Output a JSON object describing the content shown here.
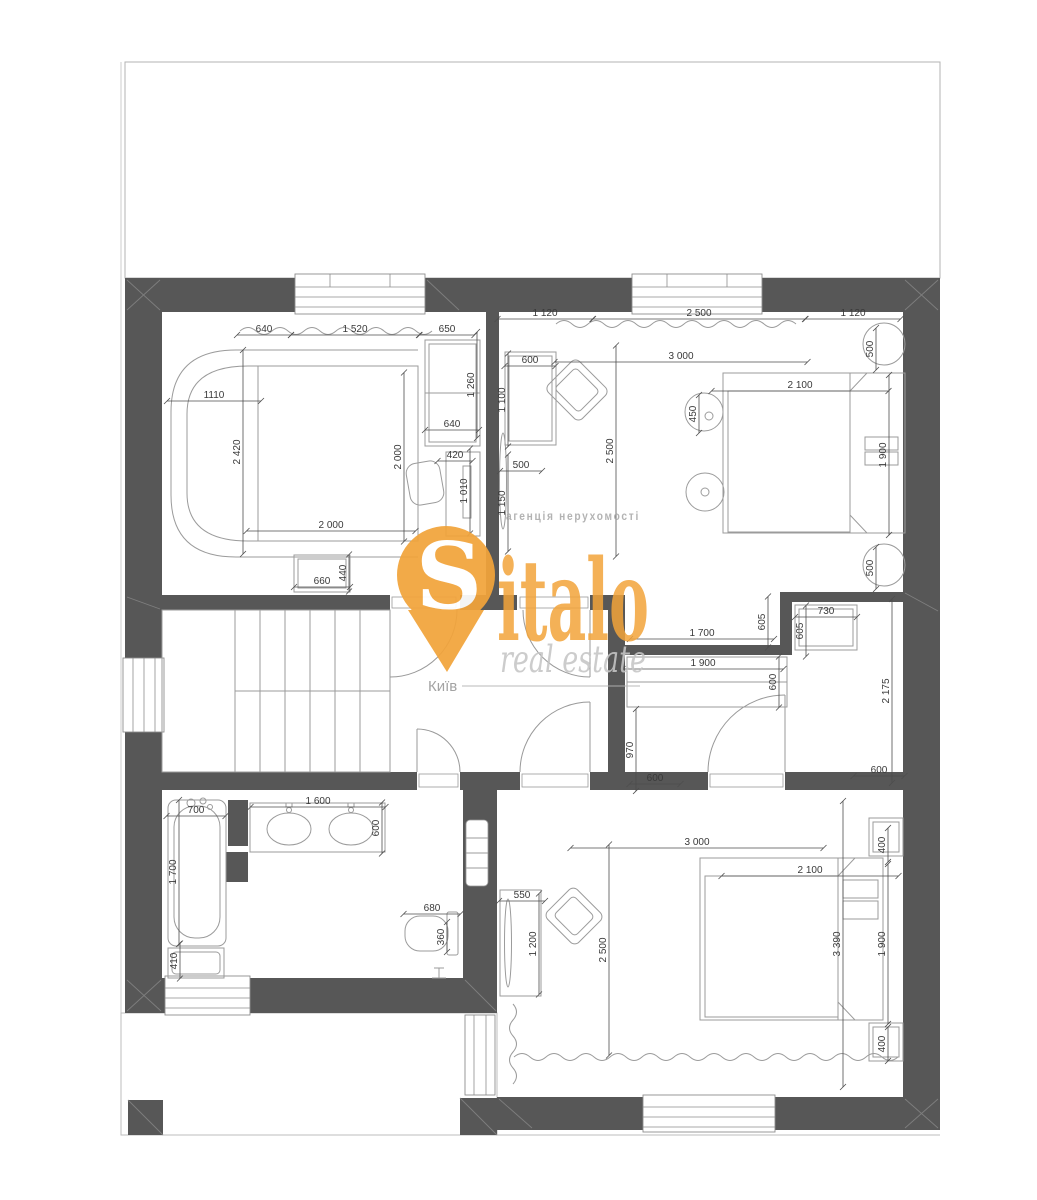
{
  "watermark": {
    "agency": "агенція нерухомості",
    "brand_initial": "S",
    "brand_rest": "italo",
    "tagline": "real estate",
    "city": "Київ"
  },
  "colors": {
    "wall": "#575757",
    "furniture_line": "#9b9b9b",
    "dimension_text": "#3a3a3a",
    "brand_orange": "#F2A43B",
    "tagline_gray": "#c6c6c6"
  },
  "dimensions": [
    {
      "t": "640",
      "x": 264,
      "y": 335,
      "r": 0,
      "l": 54
    },
    {
      "t": "1 520",
      "x": 355,
      "y": 335,
      "r": 0,
      "l": 128
    },
    {
      "t": "650",
      "x": 447,
      "y": 335,
      "r": 0,
      "l": 55
    },
    {
      "t": "1110",
      "x": 214,
      "y": 401,
      "r": 0,
      "l": 94
    },
    {
      "t": "2 420",
      "x": 243,
      "y": 452,
      "r": 1,
      "l": 204
    },
    {
      "t": "1 260",
      "x": 477,
      "y": 385,
      "r": 1,
      "l": 106
    },
    {
      "t": "640",
      "x": 452,
      "y": 430,
      "r": 0,
      "l": 54
    },
    {
      "t": "2 000",
      "x": 404,
      "y": 457,
      "r": 1,
      "l": 169
    },
    {
      "t": "420",
      "x": 455,
      "y": 461,
      "r": 0,
      "l": 35
    },
    {
      "t": "1 010",
      "x": 470,
      "y": 491,
      "r": 1,
      "l": 85
    },
    {
      "t": "2 000",
      "x": 331,
      "y": 531,
      "r": 0,
      "l": 169
    },
    {
      "t": "660",
      "x": 322,
      "y": 587,
      "r": 0,
      "l": 56
    },
    {
      "t": "440",
      "x": 349,
      "y": 573,
      "r": 1,
      "l": 37
    },
    {
      "t": "1 120",
      "x": 545,
      "y": 319,
      "r": 0,
      "l": 95
    },
    {
      "t": "2 500",
      "x": 699,
      "y": 319,
      "r": 0,
      "l": 212
    },
    {
      "t": "1 120",
      "x": 853,
      "y": 319,
      "r": 0,
      "l": 95
    },
    {
      "t": "600",
      "x": 530,
      "y": 366,
      "r": 0,
      "l": 51
    },
    {
      "t": "3 000",
      "x": 681,
      "y": 362,
      "r": 0,
      "l": 253
    },
    {
      "t": "500",
      "x": 876,
      "y": 349,
      "r": 1,
      "l": 42
    },
    {
      "t": "1 100",
      "x": 508,
      "y": 400,
      "r": 1,
      "l": 93
    },
    {
      "t": "450",
      "x": 699,
      "y": 414,
      "r": 1,
      "l": 38
    },
    {
      "t": "2 100",
      "x": 800,
      "y": 391,
      "r": 0,
      "l": 177
    },
    {
      "t": "2 500",
      "x": 616,
      "y": 451,
      "r": 1,
      "l": 211
    },
    {
      "t": "1 900",
      "x": 889,
      "y": 455,
      "r": 1,
      "l": 160
    },
    {
      "t": "500",
      "x": 521,
      "y": 471,
      "r": 0,
      "l": 42
    },
    {
      "t": "1 150",
      "x": 508,
      "y": 503,
      "r": 1,
      "l": 97
    },
    {
      "t": "500",
      "x": 876,
      "y": 568,
      "r": 1,
      "l": 42
    },
    {
      "t": "605",
      "x": 768,
      "y": 622,
      "r": 1,
      "l": 51
    },
    {
      "t": "730",
      "x": 826,
      "y": 617,
      "r": 0,
      "l": 62
    },
    {
      "t": "605",
      "x": 806,
      "y": 631,
      "r": 1,
      "l": 51
    },
    {
      "t": "1 700",
      "x": 702,
      "y": 639,
      "r": 0,
      "l": 144
    },
    {
      "t": "1 900",
      "x": 703,
      "y": 669,
      "r": 0,
      "l": 161
    },
    {
      "t": "600",
      "x": 779,
      "y": 682,
      "r": 1,
      "l": 51
    },
    {
      "t": "2 175",
      "x": 892,
      "y": 691,
      "r": 1,
      "l": 184
    },
    {
      "t": "970",
      "x": 636,
      "y": 750,
      "r": 1,
      "l": 82
    },
    {
      "t": "600",
      "x": 655,
      "y": 784,
      "r": 0,
      "l": 51
    },
    {
      "t": "600",
      "x": 879,
      "y": 776,
      "r": 0,
      "l": 51
    },
    {
      "t": "700",
      "x": 196,
      "y": 816,
      "r": 0,
      "l": 59
    },
    {
      "t": "1 600",
      "x": 318,
      "y": 807,
      "r": 0,
      "l": 135
    },
    {
      "t": "600",
      "x": 382,
      "y": 828,
      "r": 1,
      "l": 51
    },
    {
      "t": "1 700",
      "x": 179,
      "y": 872,
      "r": 1,
      "l": 144
    },
    {
      "t": "680",
      "x": 432,
      "y": 914,
      "r": 0,
      "l": 57
    },
    {
      "t": "360",
      "x": 447,
      "y": 937,
      "r": 1,
      "l": 30
    },
    {
      "t": "410",
      "x": 180,
      "y": 961,
      "r": 1,
      "l": 35
    },
    {
      "t": "3 000",
      "x": 697,
      "y": 848,
      "r": 0,
      "l": 253
    },
    {
      "t": "2 100",
      "x": 810,
      "y": 876,
      "r": 0,
      "l": 177
    },
    {
      "t": "550",
      "x": 522,
      "y": 901,
      "r": 0,
      "l": 46
    },
    {
      "t": "400",
      "x": 888,
      "y": 845,
      "r": 1,
      "l": 34
    },
    {
      "t": "1 200",
      "x": 539,
      "y": 944,
      "r": 1,
      "l": 101
    },
    {
      "t": "2 500",
      "x": 609,
      "y": 950,
      "r": 1,
      "l": 211
    },
    {
      "t": "3 390",
      "x": 843,
      "y": 944,
      "r": 1,
      "l": 286
    },
    {
      "t": "1 900",
      "x": 888,
      "y": 944,
      "r": 1,
      "l": 160
    },
    {
      "t": "400",
      "x": 888,
      "y": 1044,
      "r": 1,
      "l": 34
    }
  ]
}
